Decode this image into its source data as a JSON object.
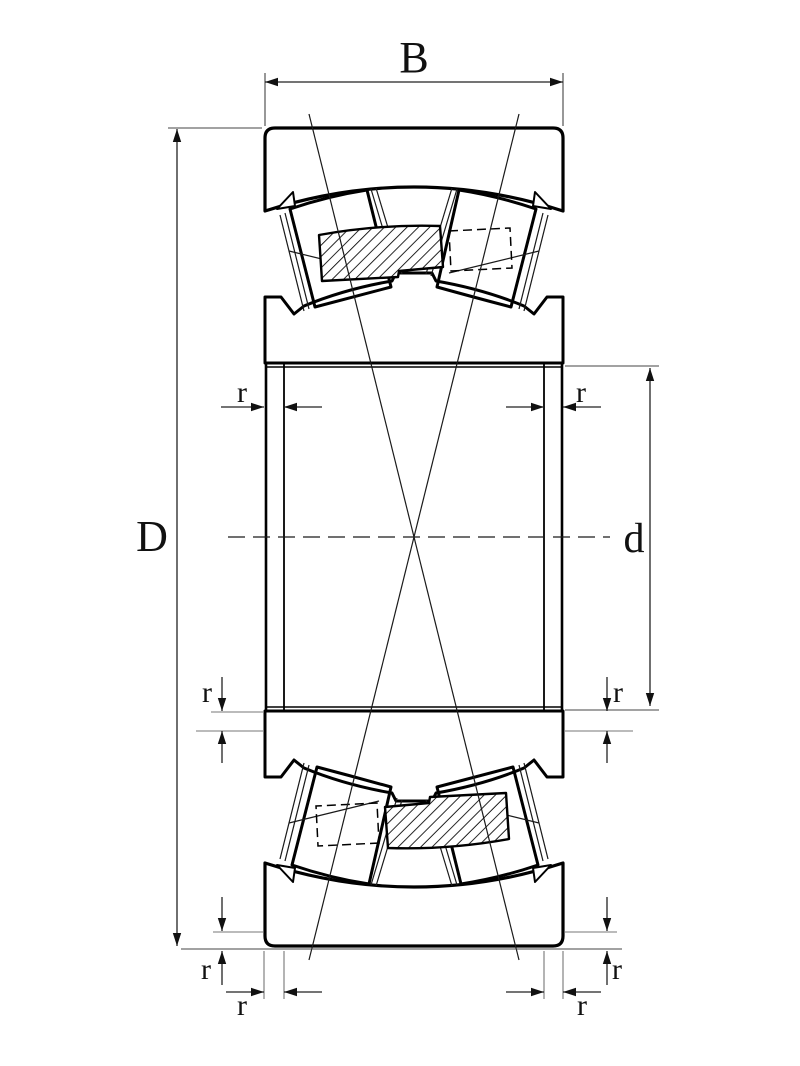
{
  "drawing": {
    "description": "Spherical roller bearing cross-section technical drawing",
    "labels": {
      "width": "B",
      "outer_diameter": "D",
      "bore_diameter": "d",
      "chamfer": "r"
    },
    "colors": {
      "background": "#ffffff",
      "line": "#000000",
      "dimension_line": "#222222"
    }
  }
}
